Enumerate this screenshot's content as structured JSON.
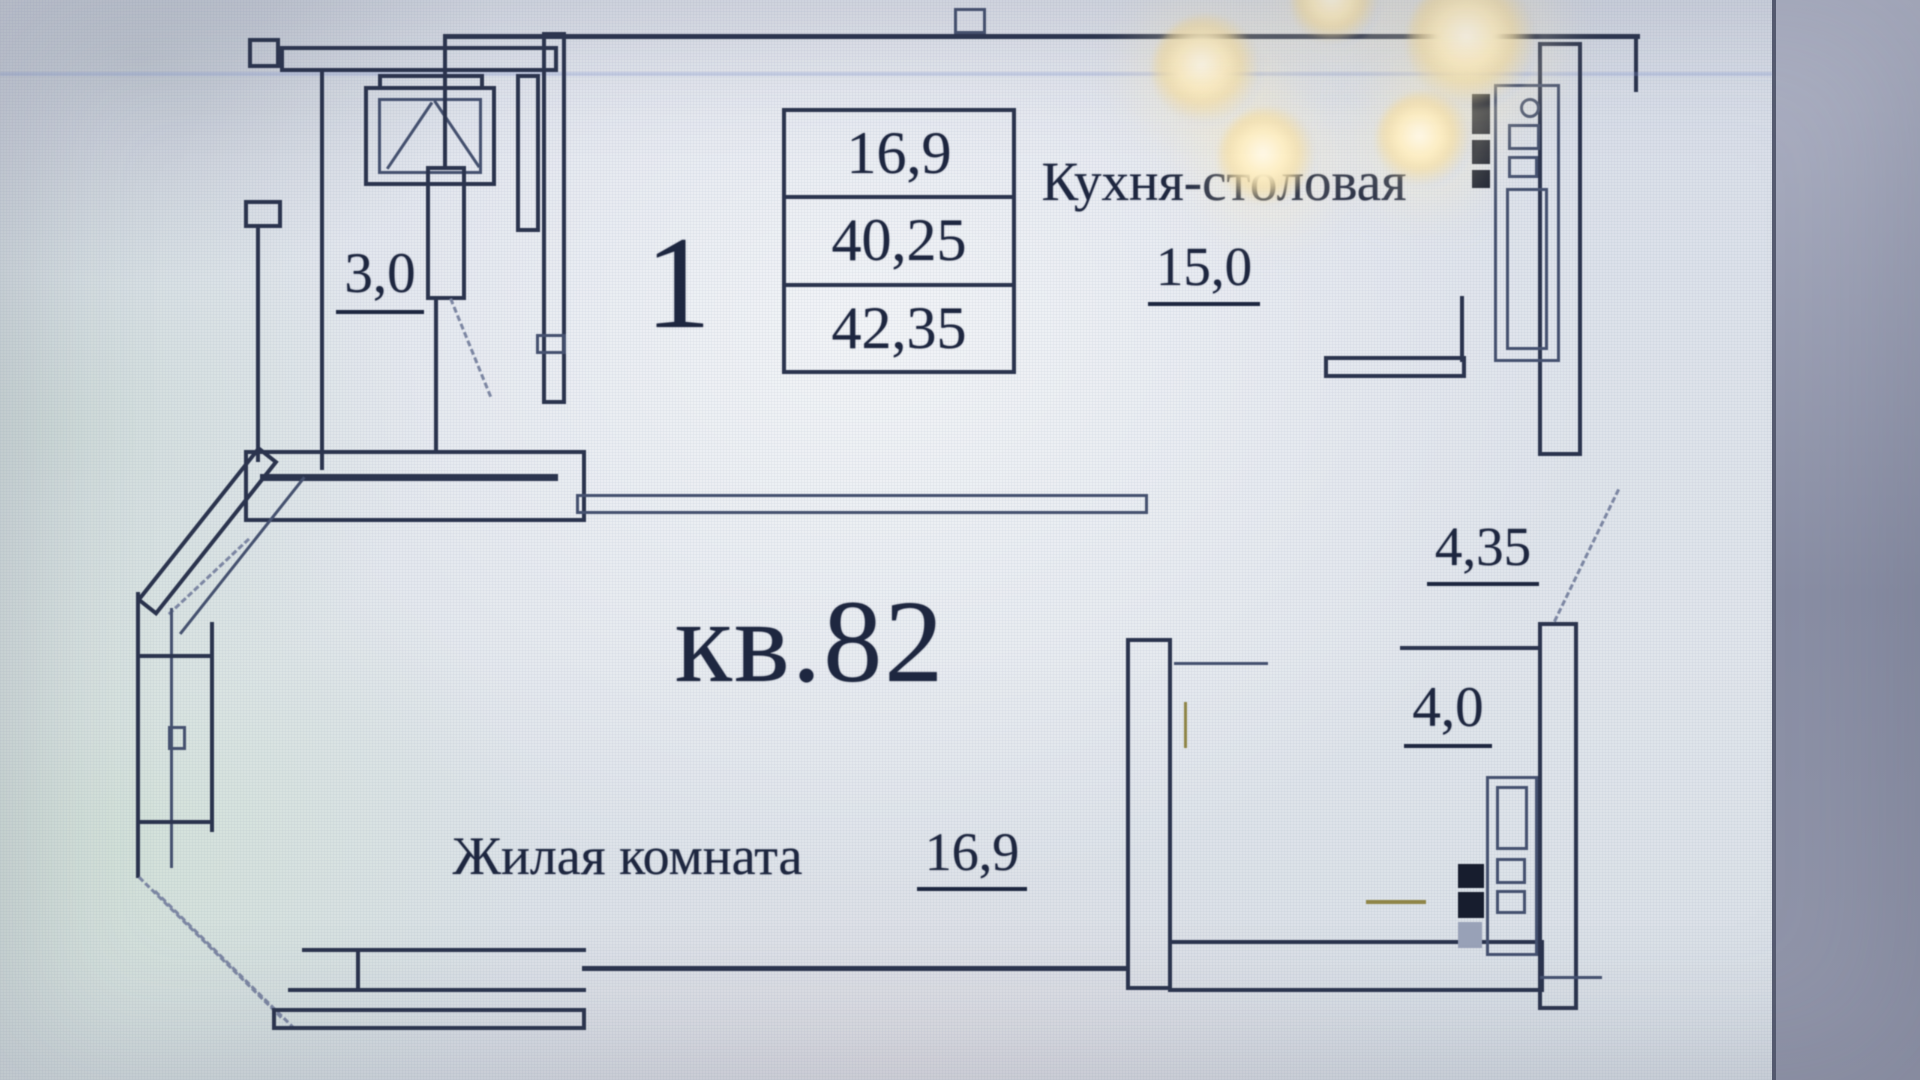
{
  "plan": {
    "apartment_label": "кв.82",
    "rooms_count": "1",
    "area_table": {
      "row1": "16,9",
      "row2": "40,25",
      "row3": "42,35"
    },
    "kitchen": {
      "label": "Кухня-столовая",
      "area": "15,0"
    },
    "living_room": {
      "label": "Жилая комната",
      "area": "16,9"
    },
    "balcony": {
      "area": "3,0"
    },
    "hallway": {
      "area": "4,35"
    },
    "bathroom": {
      "area": "4,0"
    }
  },
  "colors": {
    "ink": "#2b344e",
    "thin_line": "#45516f",
    "text": "#1e2740",
    "screen_bg": "#dfe4ec",
    "side_band": "#8d92a8",
    "glow": "#f6dfa4"
  }
}
